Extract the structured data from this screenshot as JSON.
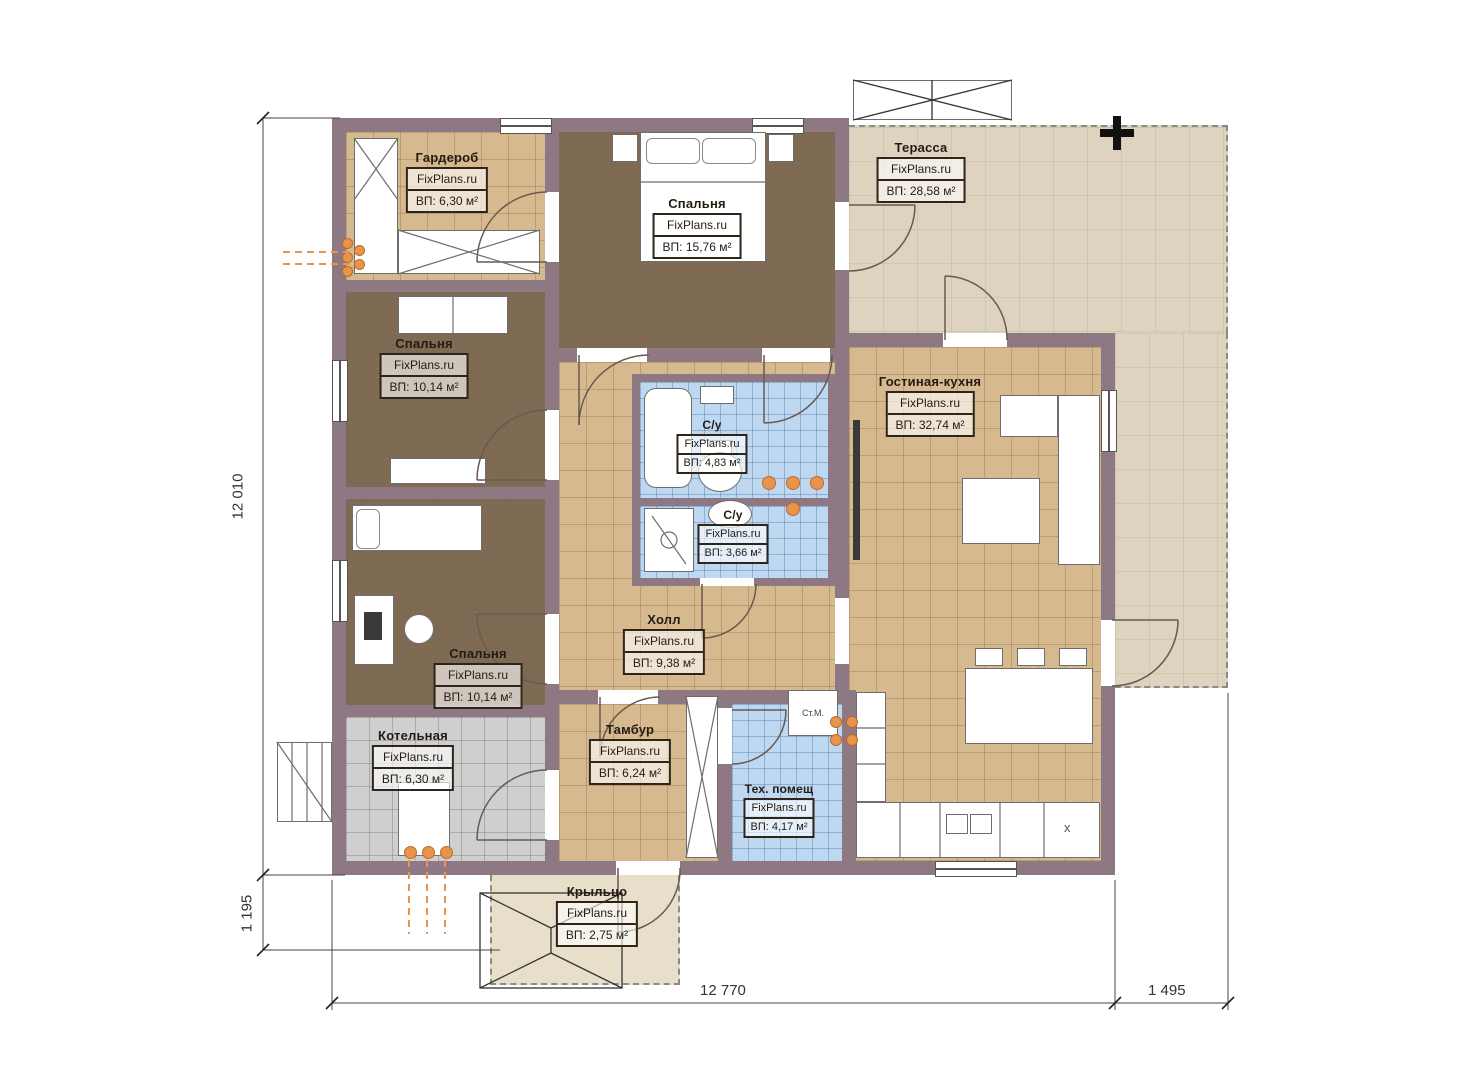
{
  "brand": "FixPlans.ru",
  "rooms": {
    "wardrobe": {
      "name": "Гардероб",
      "site": "FixPlans.ru",
      "area": "ВП: 6,30 м²"
    },
    "bedroom_top": {
      "name": "Спальня",
      "site": "FixPlans.ru",
      "area": "ВП: 15,76 м²"
    },
    "terrace": {
      "name": "Терасса",
      "site": "FixPlans.ru",
      "area": "ВП: 28,58 м²"
    },
    "bedroom_mid": {
      "name": "Спальня",
      "site": "FixPlans.ru",
      "area": "ВП: 10,14 м²"
    },
    "bath_main": {
      "name": "С/у",
      "site": "FixPlans.ru",
      "area": "ВП: 4,83 м²"
    },
    "bath_shower": {
      "name": "С/у",
      "site": "FixPlans.ru",
      "area": "ВП: 3,66 м²"
    },
    "living_kitchen": {
      "name": "Гостиная-кухня",
      "site": "FixPlans.ru",
      "area": "ВП: 32,74 м²"
    },
    "hall": {
      "name": "Холл",
      "site": "FixPlans.ru",
      "area": "ВП: 9,38 м²"
    },
    "bedroom_low": {
      "name": "Спальня",
      "site": "FixPlans.ru",
      "area": "ВП: 10,14 м²"
    },
    "boiler": {
      "name": "Котельная",
      "site": "FixPlans.ru",
      "area": "ВП: 6,30 м²"
    },
    "vestibule": {
      "name": "Тамбур",
      "site": "FixPlans.ru",
      "area": "ВП: 6,24 м²"
    },
    "tech": {
      "name": "Тех. помещ",
      "site": "FixPlans.ru",
      "area": "ВП: 4,17 м²"
    },
    "porch": {
      "name": "Крыльцо",
      "site": "FixPlans.ru",
      "area": "ВП: 2,75 м²"
    }
  },
  "annotations": {
    "washing_machine": "Ст.М.",
    "hob": "x"
  },
  "dimensions": {
    "height_total": "12 010",
    "porch_height": "1 195",
    "width_main": "12 770",
    "width_terrace": "1 495"
  },
  "colors": {
    "wall": "#8d7883",
    "tile_tan": "#d6b98e",
    "floor_dark": "#7e6a52",
    "tile_blue": "#bed8f2",
    "tile_gray": "#cfcfcf",
    "terrace": "#ddd3be",
    "porch": "#e7dfca",
    "accent_orange": "#e8944d"
  }
}
